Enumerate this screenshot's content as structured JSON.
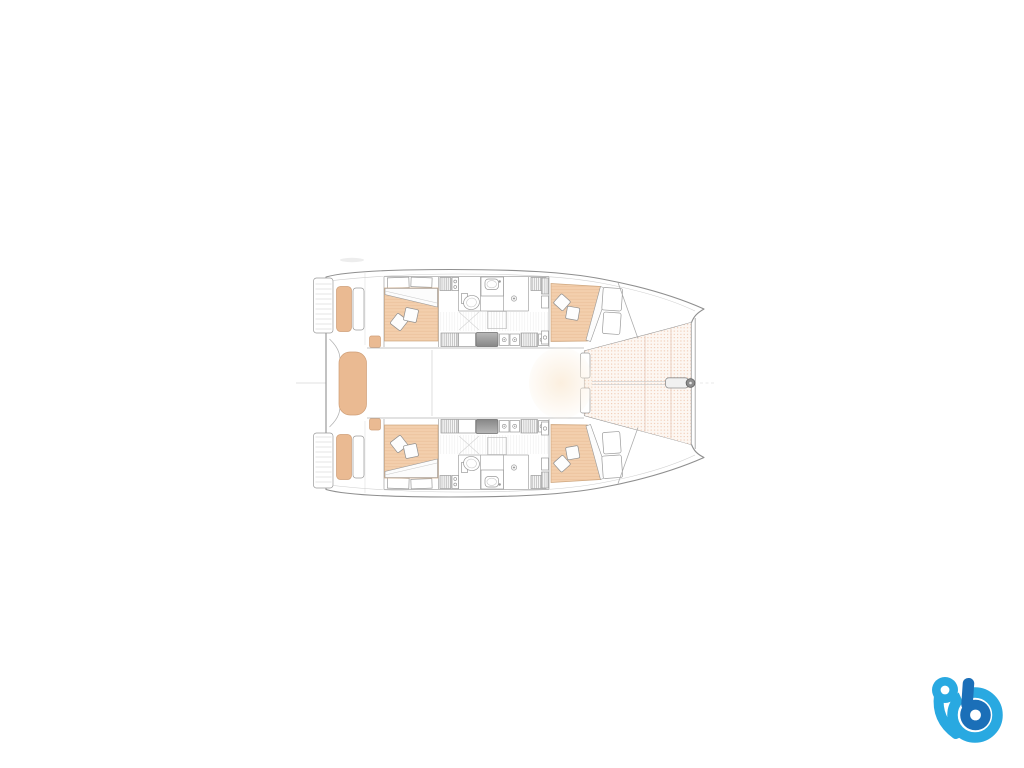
{
  "page": {
    "background_color": "#ffffff"
  },
  "floor_plan": {
    "type": "catamaran-interior-deck-plan",
    "view": "top-down",
    "orientation": {
      "bow": "right",
      "stern": "left"
    },
    "hulls": 2,
    "cabins": [
      {
        "id": "aft-port-cabin",
        "features": [
          "double-berth",
          "two-pillows",
          "folded-sheet",
          "head-shelves"
        ]
      },
      {
        "id": "forward-port-cabin",
        "features": [
          "double-berth",
          "two-pillows",
          "folded-sheet",
          "wardrobe"
        ]
      },
      {
        "id": "aft-starboard-cabin",
        "features": [
          "double-berth",
          "two-pillows",
          "folded-sheet",
          "head-shelves"
        ]
      },
      {
        "id": "forward-starboard-cabin",
        "features": [
          "double-berth",
          "two-pillows",
          "folded-sheet",
          "wardrobe"
        ]
      }
    ],
    "heads": [
      {
        "id": "port-head",
        "features": [
          "toilet",
          "sink",
          "shower-drain"
        ]
      },
      {
        "id": "starboard-head",
        "features": [
          "toilet",
          "sink",
          "shower-drain"
        ]
      }
    ],
    "areas": [
      "aft-cockpit",
      "swim-platforms",
      "cockpit-benches",
      "companionway-steps",
      "saloon",
      "forward-seats",
      "trampoline",
      "bowsprit",
      "forward-crossbeam"
    ],
    "colors": {
      "outline": "#8f8f8f",
      "wall": "#aaaaaa",
      "detail": "#c9c9c9",
      "mattress": "#f3cfad",
      "mattress_stripe": "#e9bd96",
      "bench": "#eaba92",
      "bench_edge": "#cf9f78",
      "trampoline_bg": "#fdf7f2",
      "trampoline_dot": "#eec4ab",
      "appliance_dark_1": "#b8b8b8",
      "appliance_dark_2": "#878787",
      "glow": "#fbeedd",
      "floor_stripe": "#dedede"
    }
  },
  "logo": {
    "name": "stylized-b-boat-logo",
    "position": "bottom-right",
    "colors": {
      "light_blue": "#29a9e1",
      "dark_blue": "#1b6fb8"
    }
  }
}
